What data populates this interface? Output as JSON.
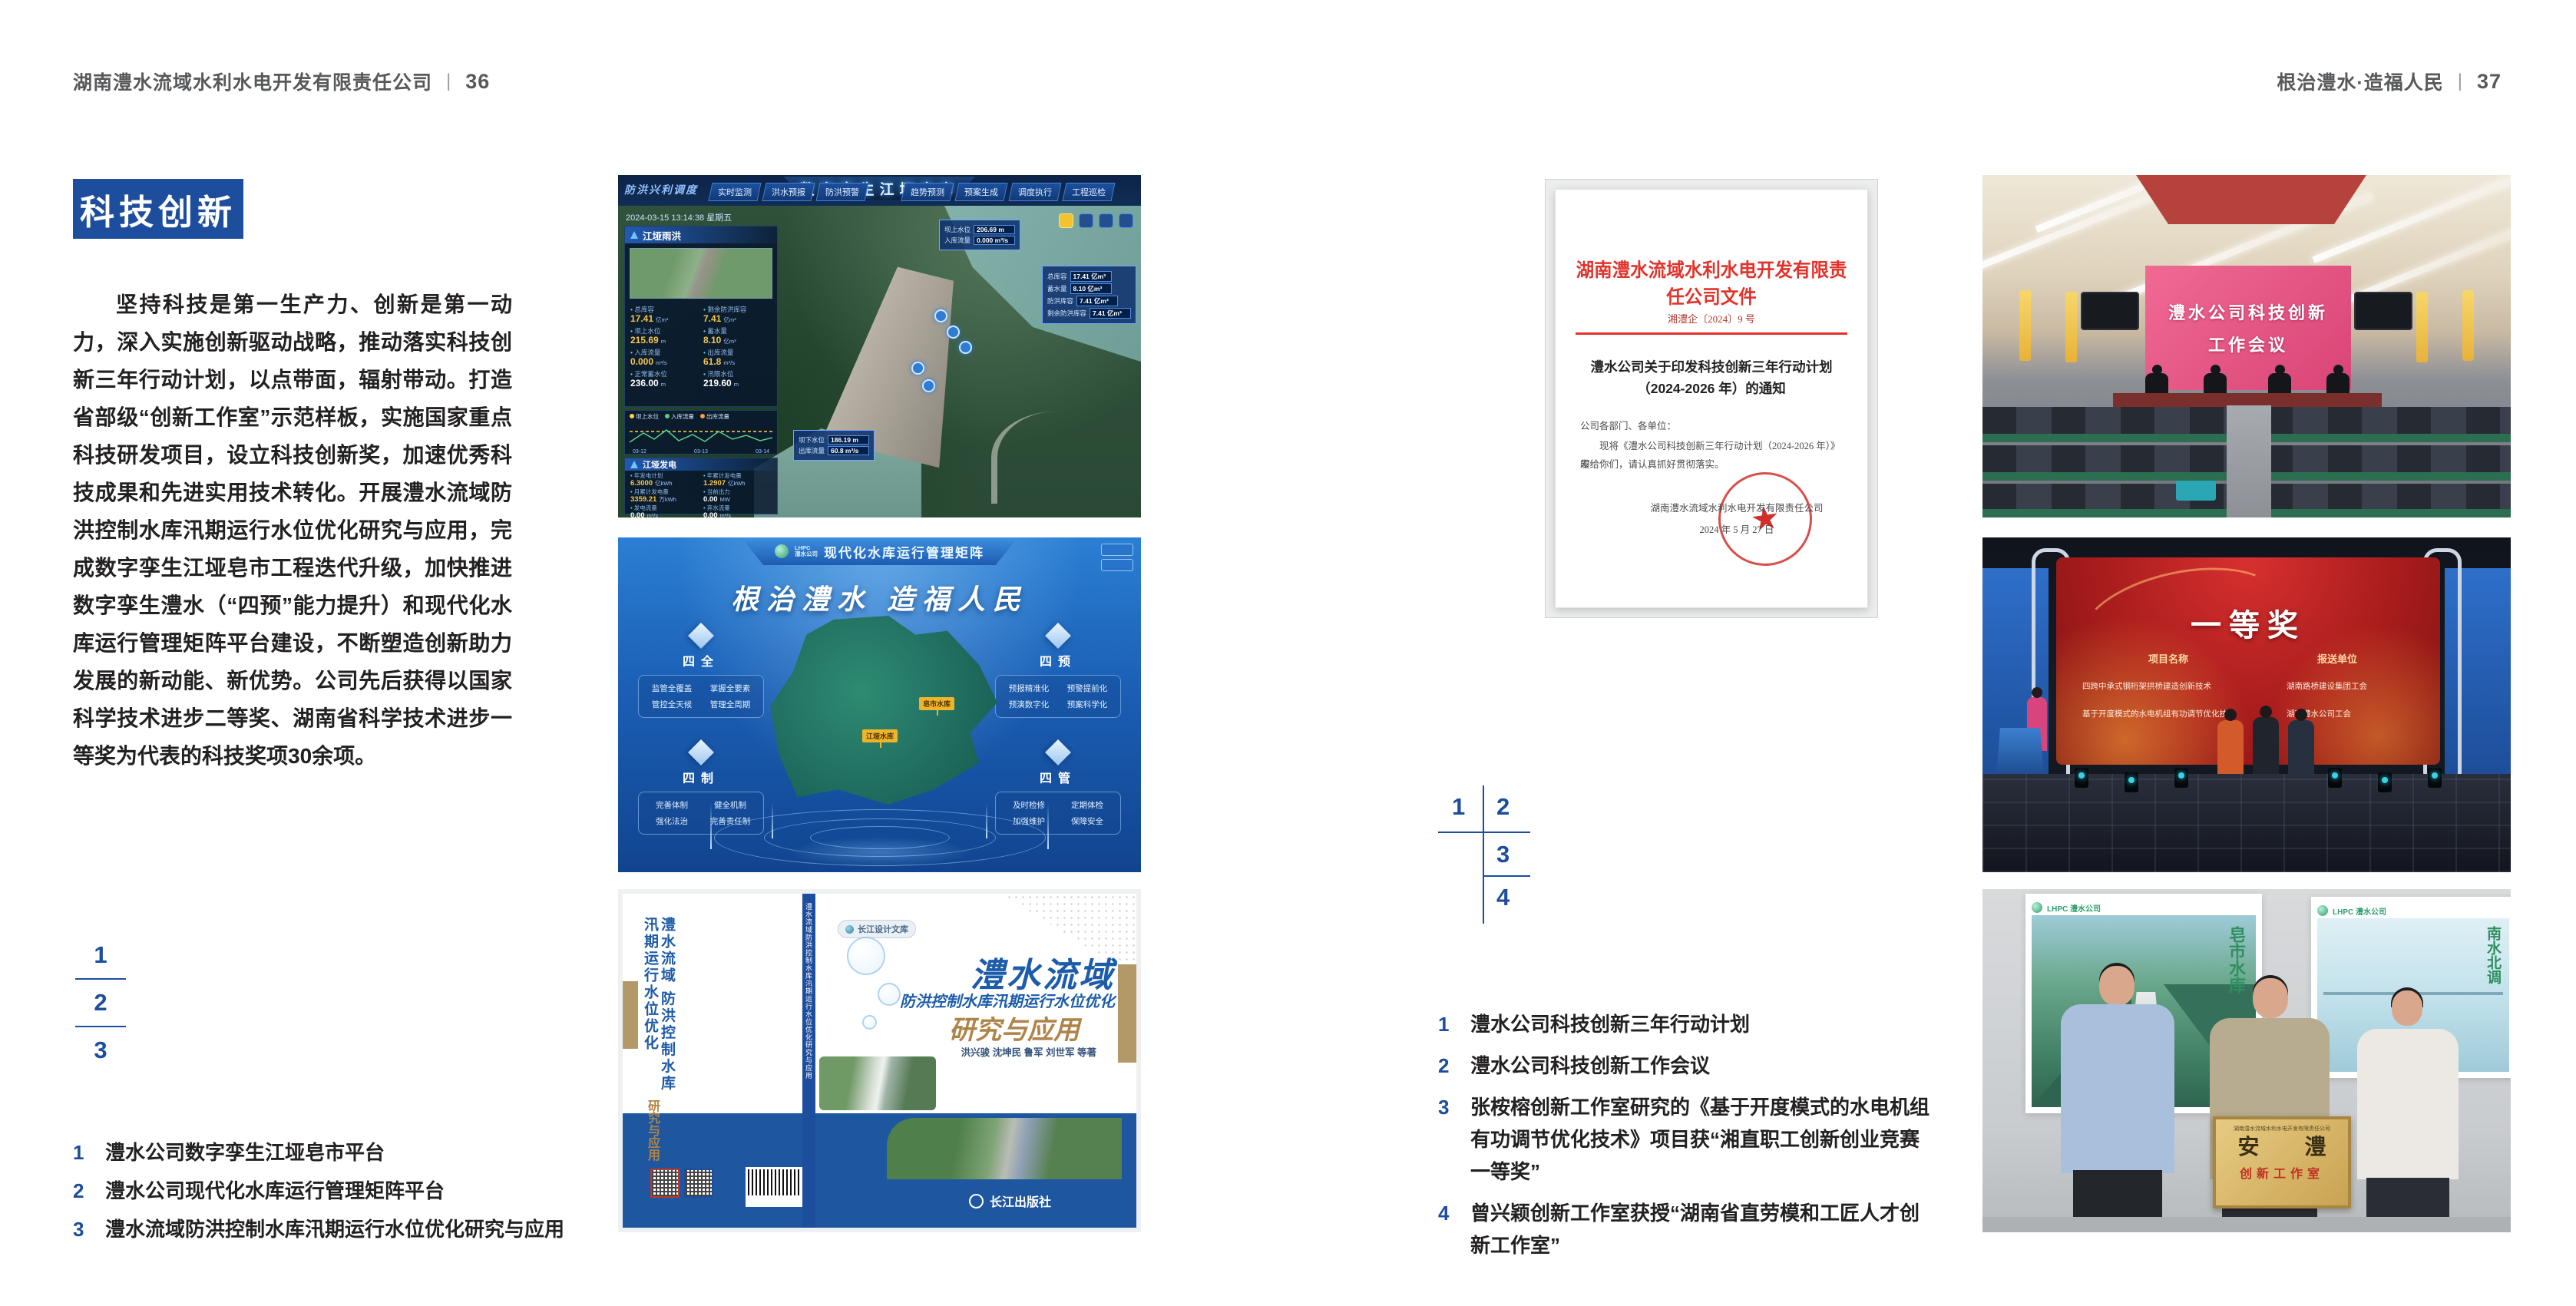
{
  "colors": {
    "accent_blue": "#1d4d9d",
    "header_gray": "#58595b",
    "body_text": "#232022",
    "doc_red": "#e2322a"
  },
  "left_page": {
    "header": {
      "company": "湖南澧水流域水利水电开发有限责任公司",
      "divider": "|",
      "page_number": "36"
    },
    "section_title": "科技创新",
    "body_paragraph": "坚持科技是第一生产力、创新是第一动力，深入实施创新驱动战略，推动落实科技创新三年行动计划，以点带面，辐射带动。打造省部级“创新工作室”示范样板，实施国家重点科技研发项目，设立科技创新奖，加速优秀科技成果和先进实用技术转化。开展澧水流域防洪控制水库汛期运行水位优化研究与应用，完成数字孪生江垭皂市工程迭代升级，加快推进数字孪生澧水（“四预”能力提升）和现代化水库运行管理矩阵平台建设，不断塑造创新助力发展的新动能、新优势。公司先后获得以国家科学技术进步二等奖、湖南省科学技术进步一等奖为代表的科技奖项30余项。",
    "figure_index": [
      "1",
      "2",
      "3"
    ],
    "captions": [
      {
        "num": "1",
        "text": "澧水公司数字孪生江垭皂市平台"
      },
      {
        "num": "2",
        "text": "澧水公司现代化水库运行管理矩阵平台"
      },
      {
        "num": "3",
        "text": "澧水流域防洪控制水库汛期运行水位优化研究与应用"
      }
    ]
  },
  "right_page": {
    "header": {
      "slogan": "根治澧水·造福人民",
      "divider": "|",
      "page_number": "37"
    },
    "figure_index": [
      "1",
      "2",
      "3",
      "4"
    ],
    "captions": [
      {
        "num": "1",
        "text": "澧水公司科技创新三年行动计划"
      },
      {
        "num": "2",
        "text": "澧水公司科技创新工作会议"
      },
      {
        "num": "3",
        "text": "张桉榕创新工作室研究的《基于开度模式的水电机组有功调节优化技术》项目获“湘直职工创新创业竞赛一等奖”"
      },
      {
        "num": "4",
        "text": "曾兴颖创新工作室获授“湖南省直劳模和工匠人才创新工作室”"
      }
    ]
  },
  "figures": {
    "dashboard": {
      "title": "数字孪生江垭皂市",
      "corner_label": "防洪兴利调度",
      "timestamp": "2024-03-15 13:14:38 星期五",
      "tabs_left": [
        "实时监测",
        "洪水预报",
        "防洪预警"
      ],
      "tabs_right": [
        "趋势预测",
        "预案生成",
        "调度执行",
        "工程巡检"
      ],
      "panel_rain": {
        "title": "江垭雨洪",
        "stats": [
          {
            "l": "总库容",
            "v": "17.41",
            "u": "亿m³"
          },
          {
            "l": "剩余防洪库容",
            "v": "7.41",
            "u": "亿m³"
          },
          {
            "l": "坝上水位",
            "v": "215.69",
            "u": "m"
          },
          {
            "l": "蓄水量",
            "v": "8.10",
            "u": "亿m³"
          },
          {
            "l": "入库流量",
            "v": "0.000",
            "u": "m³/s"
          },
          {
            "l": "出库流量",
            "v": "61.8",
            "u": "m³/s"
          },
          {
            "l": "正常蓄水位",
            "v": "236.00",
            "u": "m"
          },
          {
            "l": "汛限水位",
            "v": "219.60",
            "u": "m"
          }
        ]
      },
      "chart": {
        "legend": [
          "坝上水位",
          "入库流量",
          "出库流量"
        ],
        "x_labels": [
          "03-12",
          "03-13",
          "03-14"
        ]
      },
      "panel_power": {
        "title": "江垭发电",
        "stats": [
          {
            "l": "年发电计划",
            "v": "6.3000",
            "u": "亿kWh"
          },
          {
            "l": "年累计发电量",
            "v": "1.2907",
            "u": "亿kWh"
          },
          {
            "l": "月累计发电量",
            "v": "3359.21",
            "u": "万kWh"
          },
          {
            "l": "当前出力",
            "v": "0.00",
            "u": "MW"
          },
          {
            "l": "发电流量",
            "v": "0.00",
            "u": "m³/s"
          },
          {
            "l": "弃水流量",
            "v": "0.00",
            "u": "m³/s"
          }
        ],
        "units": [
          "1#机组",
          "2#机组",
          "3#机组"
        ]
      },
      "tag_up": {
        "l1": "坝上水位",
        "v1": "206.69 m",
        "l2": "入库流量",
        "v2": "0.000 m³/s"
      },
      "tag_info": [
        {
          "l": "总库容",
          "v": "17.41 亿m³"
        },
        {
          "l": "蓄水量",
          "v": "8.10 亿m³"
        },
        {
          "l": "防洪库容",
          "v": "7.41 亿m³"
        },
        {
          "l": "剩余防洪库容",
          "v": "7.41 亿m³"
        }
      ],
      "tag_down": {
        "l1": "坝下水位",
        "v1": "186.19 m",
        "l2": "出库流量",
        "v2": "60.8 m³/s"
      }
    },
    "matrix": {
      "logo_line1": "LHPC",
      "logo_line2": "澧水公司",
      "title": "现代化水库运行管理矩阵",
      "slogan": "根治澧水 造福人民",
      "groups": [
        {
          "name": "四全",
          "items": [
            "监管全覆盖",
            "掌握全要素",
            "管控全天候",
            "管理全周期"
          ]
        },
        {
          "name": "四预",
          "items": [
            "预报精准化",
            "预警提前化",
            "预演数字化",
            "预案科学化"
          ]
        },
        {
          "name": "四制",
          "items": [
            "完善体制",
            "健全机制",
            "强化法治",
            "完善责任制"
          ]
        },
        {
          "name": "四管",
          "items": [
            "及时检修",
            "定期体检",
            "加强维护",
            "保障安全"
          ]
        }
      ],
      "map_labels": [
        "皂市水库",
        "江垭水库"
      ]
    },
    "book": {
      "series_badge": "长江设计文库",
      "title": "澧水流域",
      "subtitle": "防洪控制水库汛期运行水位优化",
      "subtitle2": "研究与应用",
      "authors": "洪兴骏 沈坤民 鲁军 刘世军 等著",
      "publisher": "长江出版社",
      "spine_text": "澧水流域防洪控制水库汛期运行水位优化研究与应用",
      "back_title": "澧水流域 防洪控制水库汛期运行水位优化",
      "back_title2": "研究与应用"
    },
    "document": {
      "header": "湖南澧水流域水利水电开发有限责任公司文件",
      "number": "湘澧企〔2024〕9 号",
      "title_line1": "澧水公司关于印发科技创新三年行动计划",
      "title_line2": "（2024-2026 年）的通知",
      "salutation": "公司各部门、各单位：",
      "body_line1": "现将《澧水公司科技创新三年行动计划（2024-2026 年）》印",
      "body_line2": "发给你们，请认真抓好贯彻落实。",
      "signer": "湖南澧水流域水利水电开发有限责任公司",
      "date": "2024 年 5 月 27 日"
    },
    "meeting": {
      "screen_line1": "澧水公司科技创新",
      "screen_line2": "工作会议"
    },
    "award": {
      "title": "一等奖",
      "col_project": "项目名称",
      "col_unit": "报送单位",
      "rows": [
        {
          "project": "四跨中承式钢桁架拱桥建造创新技术",
          "unit": "湖南路桥建设集团工会"
        },
        {
          "project": "基于开度模式的水电机组有功调节优化技术",
          "unit": "湖南澧水公司工会"
        }
      ]
    },
    "group": {
      "plaque_org": "湖南澧水流域水利水电开发有限责任公司",
      "plaque_title": "安 澧",
      "plaque_subtitle": "创新工作室",
      "poster_left_logo": "LHPC 澧水公司",
      "poster_left_text": "皂市水库",
      "poster_right_logo": "LHPC 澧水公司",
      "poster_right_text": "南水北调"
    }
  }
}
